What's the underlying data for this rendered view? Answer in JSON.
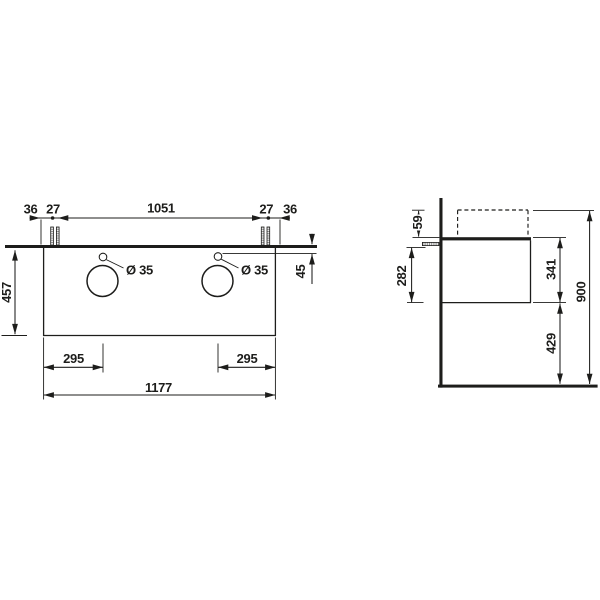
{
  "front_view": {
    "top_dims": {
      "edge_left": "36",
      "pair_left": "27",
      "span_center": "1051",
      "pair_right": "27",
      "edge_right": "36"
    },
    "height": "457",
    "top_thickness": "45",
    "faucet_hole_left": "Ø 35",
    "faucet_hole_right": "Ø 35",
    "bottom_dims": {
      "basin_left": "295",
      "basin_right": "295",
      "total_width": "1177"
    }
  },
  "side_view": {
    "basin_top_offset": "59",
    "bolt_to_cabinet_bottom": "282",
    "cabinet_height": "341",
    "bottom_clearance": "429",
    "total_height": "900"
  },
  "colors": {
    "line": "#1d1d1b",
    "background": "#ffffff"
  }
}
